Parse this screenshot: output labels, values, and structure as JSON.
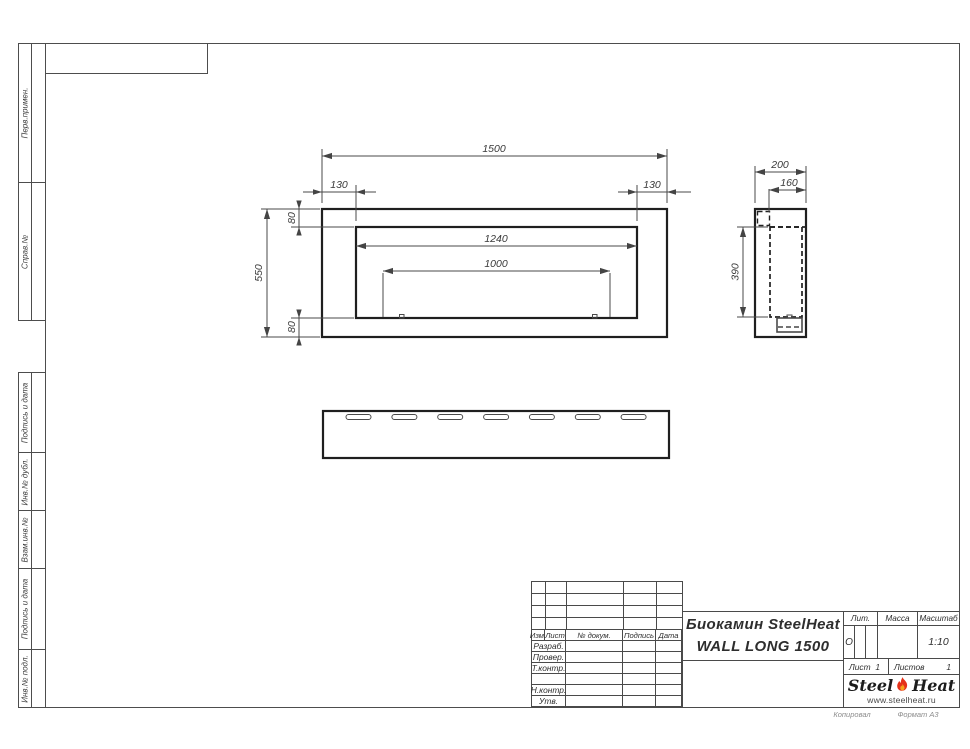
{
  "side_labels": {
    "perv": "Перв.примен.",
    "sprav": "Справ.№",
    "podpis1": "Подпись и дата",
    "inv_dubl": "Инв.№ дубл.",
    "vzam": "Взам.инв.№",
    "podpis2": "Подпись и дата",
    "inv_podl": "Инв.№ подл."
  },
  "title_block": {
    "header": {
      "izm": "Изм.",
      "list": "Лист",
      "doc": "№ докум.",
      "podpis": "Подпись",
      "data": "Дата"
    },
    "rows": {
      "razrab": "Разраб.",
      "prover": "Провер.",
      "tkontr": "Т.контр.",
      "nkontr": "Н.контр.",
      "utv": "Утв."
    },
    "title_line1": "Биокамин SteelHeat",
    "title_line2": "WALL LONG 1500",
    "lit_label": "Лит.",
    "lit_value": "О",
    "mass_label": "Масса",
    "scale_label": "Масштаб",
    "scale_value": "1:10",
    "sheet_label": "Лист",
    "sheet_value": "1",
    "sheets_label": "Листов",
    "sheets_value": "1",
    "logo": {
      "steel": "Steel",
      "heat": "Heat",
      "url": "www.steelheat.ru"
    },
    "footer_left": "Копировал",
    "footer_right": "Формат А3",
    "flame_color": "#e53119",
    "flame_inner_color": "#f6a21c"
  },
  "dims": {
    "front": {
      "width": "1500",
      "inset_left": "130",
      "inset_right": "130",
      "top": "80",
      "bottom": "80",
      "height": "550",
      "opening_width": "1240",
      "burner_width": "1000"
    },
    "side": {
      "depth": "200",
      "inner_depth": "160",
      "inner_height": "390"
    }
  },
  "views": {
    "bottom_slots": 7
  }
}
